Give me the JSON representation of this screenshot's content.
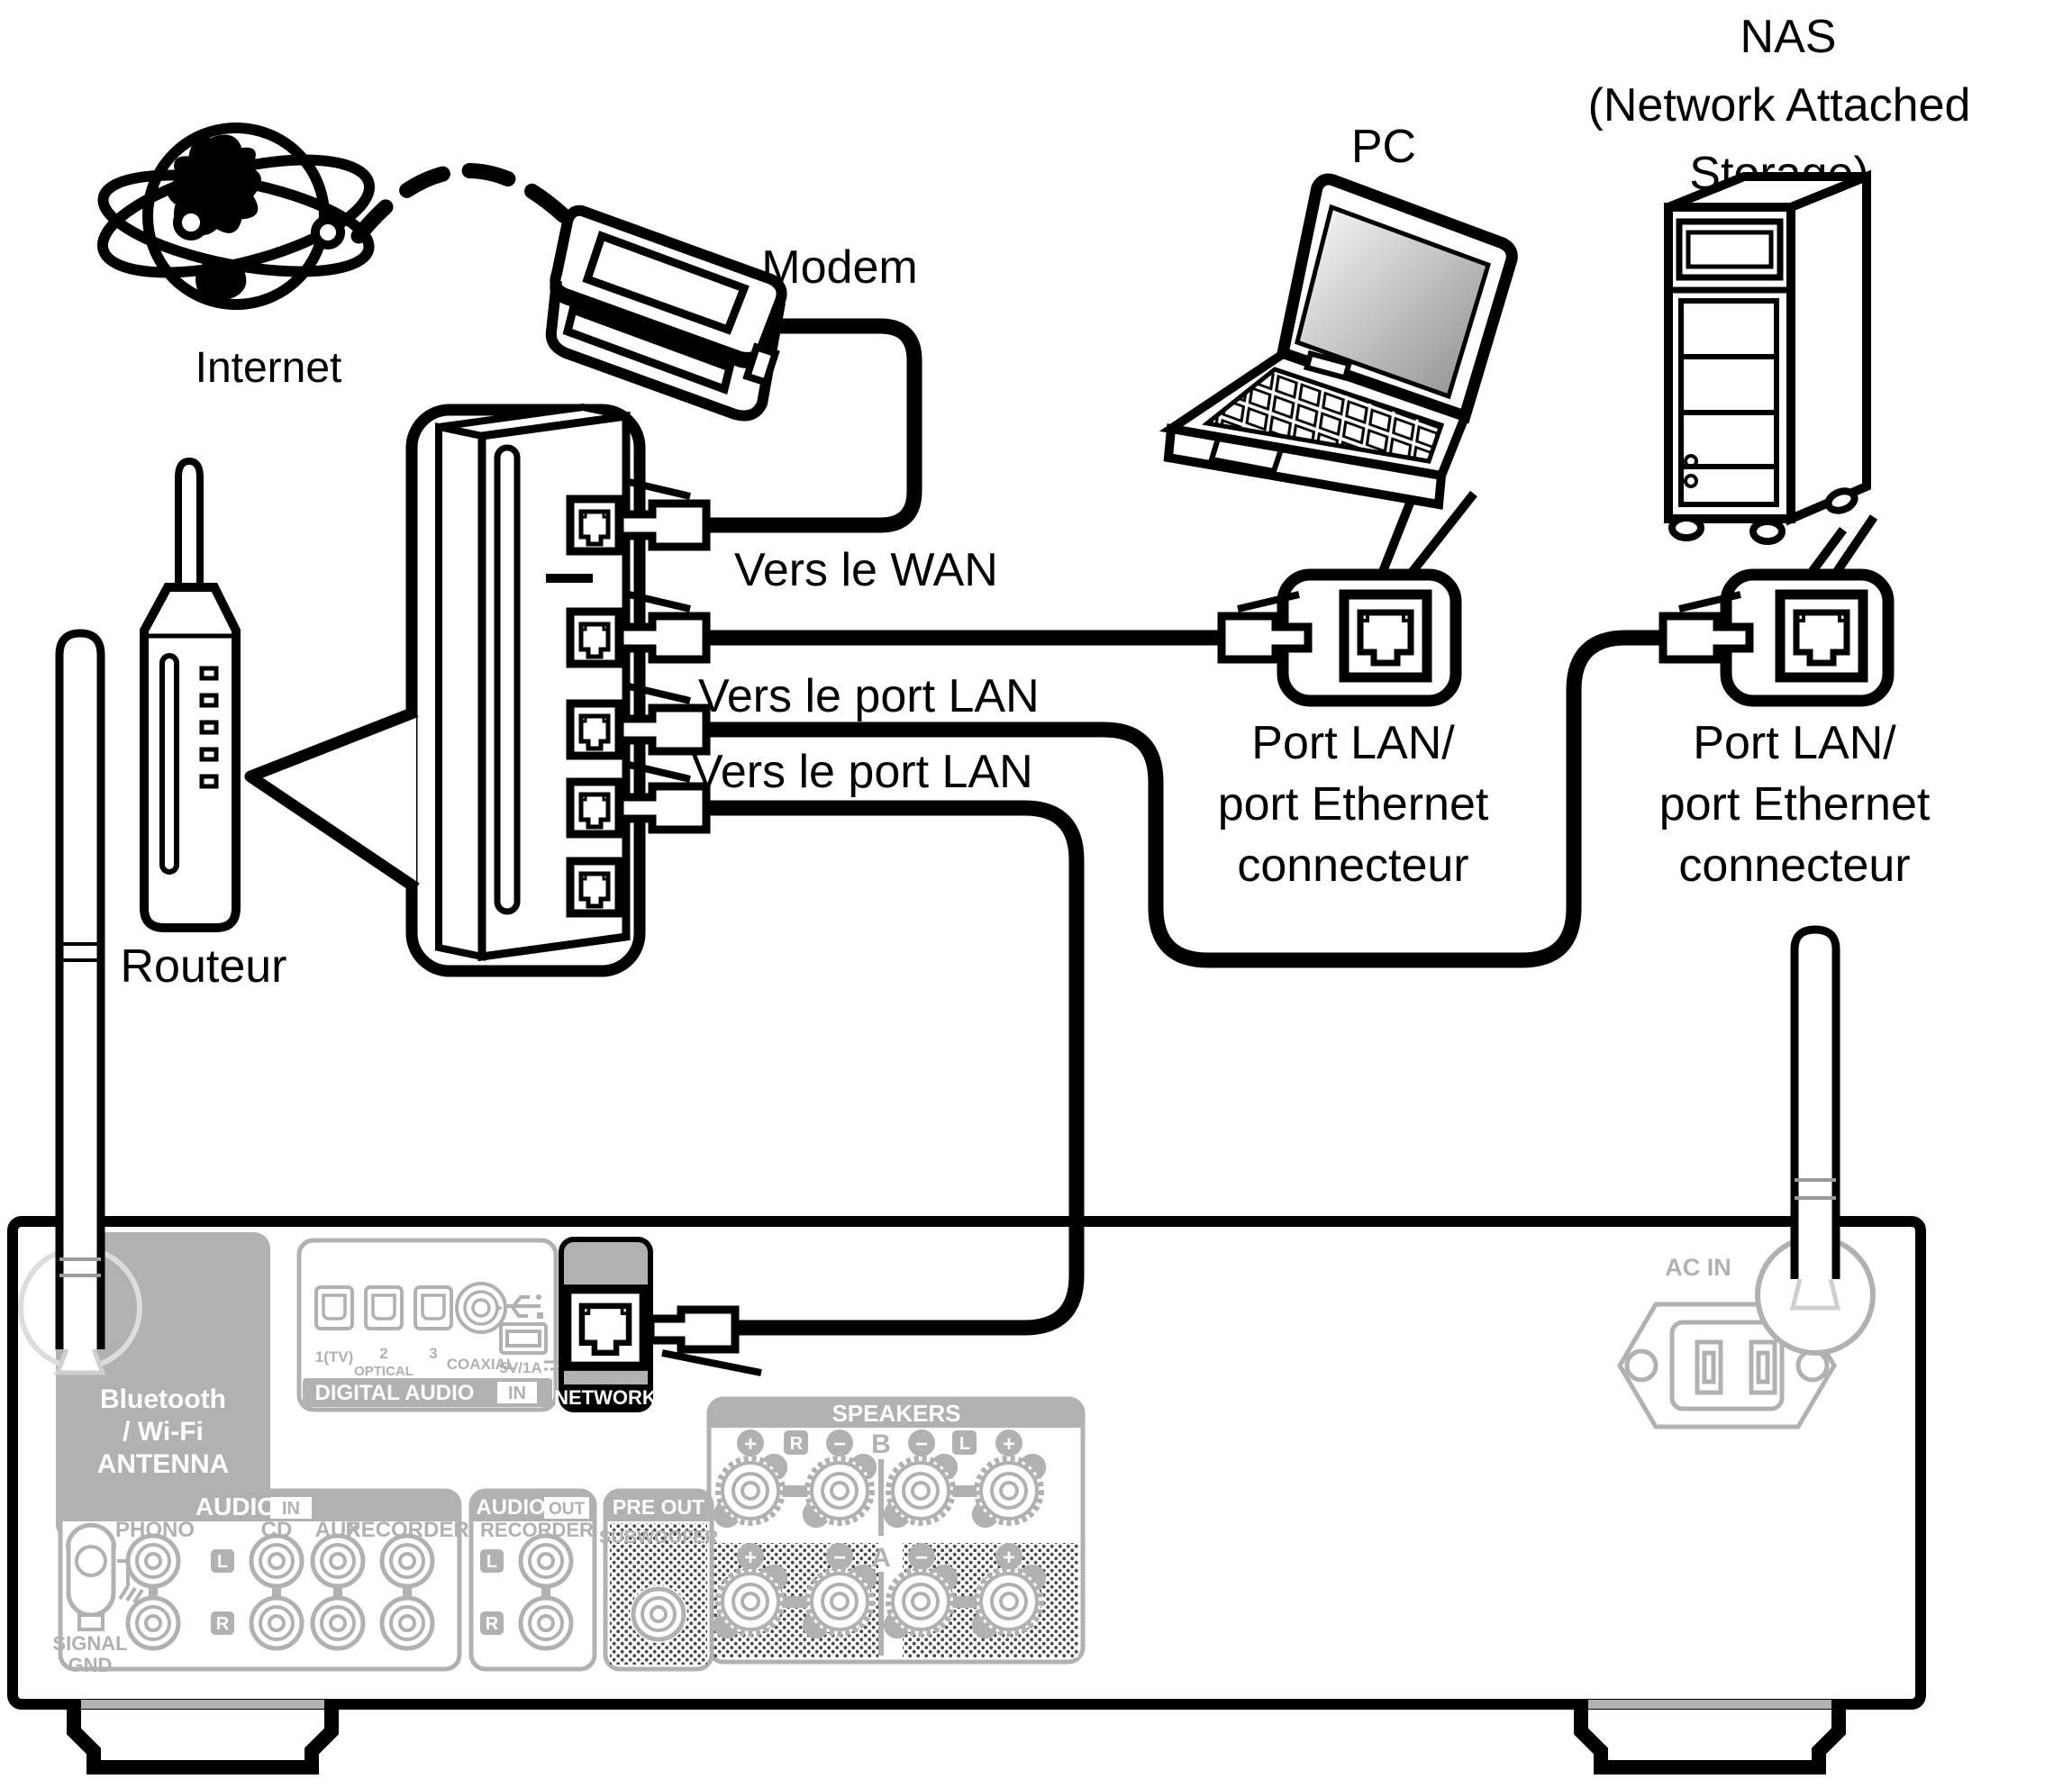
{
  "labels": {
    "internet": "Internet",
    "modem": "Modem",
    "router": "Routeur",
    "to_wan": "Vers le WAN",
    "to_lan_1": "Vers le port LAN",
    "to_lan_2": "Vers le port LAN",
    "pc": "PC",
    "nas_line1": "NAS",
    "nas_line2": "(Network Attached",
    "nas_line3": "Storage)",
    "pc_port_line1": "Port LAN/",
    "pc_port_line2": "port Ethernet",
    "pc_port_line3": "connecteur",
    "nas_port_line1": "Port LAN/",
    "nas_port_line2": "port Ethernet",
    "nas_port_line3": "connecteur"
  },
  "receiver": {
    "antenna_block": {
      "line1": "Bluetooth",
      "line2": "/ Wi-Fi",
      "line3": "ANTENNA"
    },
    "digital_audio": {
      "title": "DIGITAL AUDIO",
      "badge": "IN",
      "port1": "1(TV)",
      "port2": "2",
      "port2_sub": "OPTICAL",
      "port3": "3",
      "coaxial": "COAXIAL",
      "usb": "5V/1A"
    },
    "network": {
      "label": "NETWORK"
    },
    "speakers": {
      "title": "SPEAKERS",
      "plus": "+",
      "minus": "−",
      "r": "R",
      "l": "L",
      "b": "B",
      "a": "A"
    },
    "audio_in": {
      "title": "AUDIO",
      "badge": "IN",
      "phono": "PHONO",
      "cd": "CD",
      "aux": "AUX",
      "recorder": "RECORDER",
      "l": "L",
      "r": "R",
      "gnd1": "SIGNAL",
      "gnd2": "GND"
    },
    "audio_out": {
      "title": "AUDIO",
      "badge": "OUT",
      "recorder": "RECORDER",
      "l": "L",
      "r": "R"
    },
    "pre_out": {
      "title": "PRE OUT",
      "sub": "SUBWOOFER"
    },
    "ac_in": "AC IN"
  },
  "colors": {
    "line_black": "#000000",
    "panel_gray": "#b1b1b1",
    "halftone": "#4a4a4a"
  }
}
